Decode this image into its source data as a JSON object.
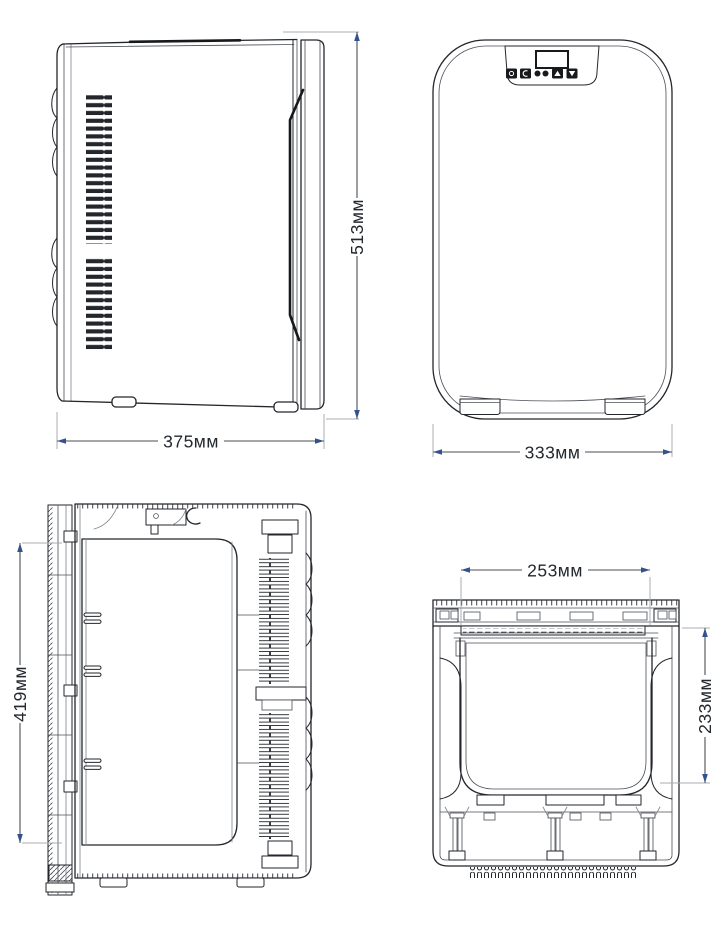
{
  "drawing": {
    "subject": "mini-fridge-four-view-technical-drawing",
    "background": "#ffffff"
  },
  "colors": {
    "line": "#23262b",
    "thick_line": "#17191c",
    "dimension_line": "#4a4f55",
    "extension_line": "#a9adb2",
    "arrow": "#33518f",
    "text": "#23272e"
  },
  "dimensions": {
    "side_width": "375мм",
    "side_height": "513мм",
    "front_width": "333мм",
    "section_height": "419мм",
    "top_inner_width": "253мм",
    "top_inner_depth": "233мм"
  }
}
